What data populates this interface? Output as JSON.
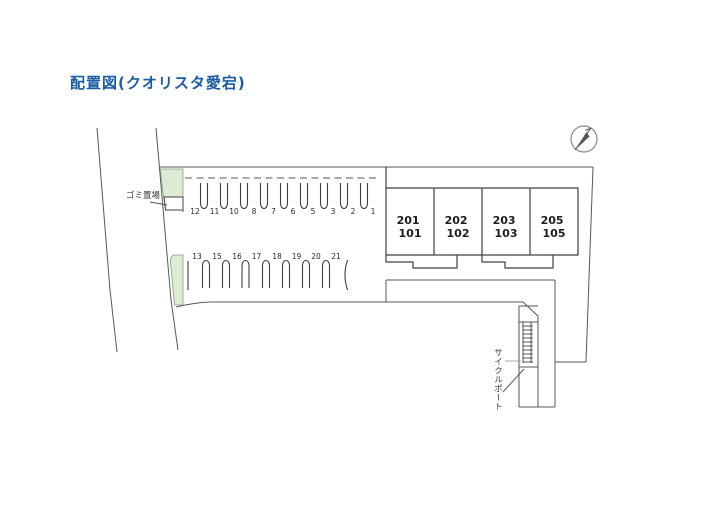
{
  "title": "配置図(クオリスタ愛宕)",
  "plan": {
    "garbage_label": "ゴミ置場",
    "cycle_port_label": "サイクルポート",
    "parking": {
      "row1": [
        "12",
        "11",
        "10",
        "8",
        "7",
        "6",
        "5",
        "3",
        "2",
        "1"
      ],
      "row2": [
        "13",
        "15",
        "16",
        "17",
        "18",
        "19",
        "20",
        "21"
      ]
    },
    "units": [
      {
        "upper": "201",
        "lower": "101"
      },
      {
        "upper": "202",
        "lower": "102"
      },
      {
        "upper": "203",
        "lower": "103"
      },
      {
        "upper": "205",
        "lower": "105"
      }
    ]
  },
  "colors": {
    "title_blue": "#1b5ca4",
    "green_area": "#dcebd2",
    "line_gray": "#56575b",
    "dark_line": "#3f4043"
  },
  "icons": {
    "north": "north-arrow-icon"
  }
}
